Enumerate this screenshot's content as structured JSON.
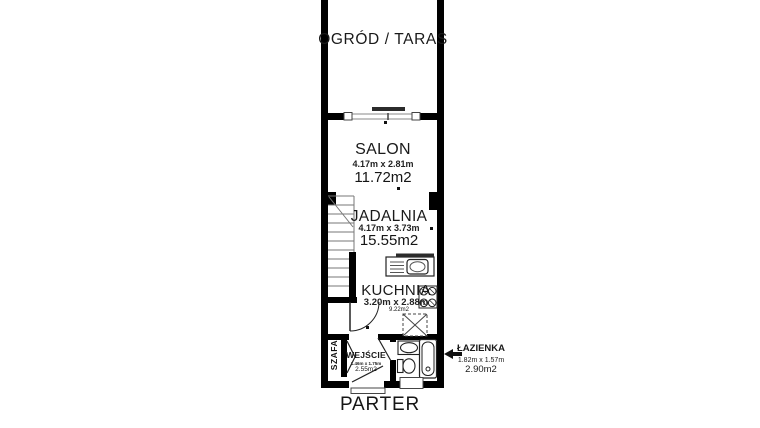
{
  "floor_plan": {
    "title": "PARTER",
    "outdoor": {
      "label": "OGRÓD / TARAS"
    },
    "rooms": {
      "salon": {
        "name": "SALON",
        "dimensions": "4.17m x 2.81m",
        "area": "11.72m2"
      },
      "jadalnia": {
        "name": "JADALNIA",
        "dimensions": "4.17m x 3.73m",
        "area": "15.55m2"
      },
      "kuchnia": {
        "name": "KUCHNIA",
        "dimensions": "3.20m x 2.88m",
        "area": "9.22m2"
      },
      "wejscie": {
        "name": "WEJŚCIE",
        "dimensions": "1.46m x 1.75m",
        "area": "2.55m2"
      },
      "szafa": {
        "name": "SZAFA"
      },
      "lazienka": {
        "name": "ŁAZIENKA",
        "dimensions": "1.82m x 1.57m",
        "area": "2.90m2"
      }
    },
    "icons": {
      "lazienka_pointer": "left-arrow-icon"
    },
    "colors": {
      "walls": "#000000",
      "background": "#ffffff",
      "fixture_outline": "#222222",
      "stair_lines": "#8a8a8a",
      "sliding_door": "#2b2b2b"
    }
  }
}
